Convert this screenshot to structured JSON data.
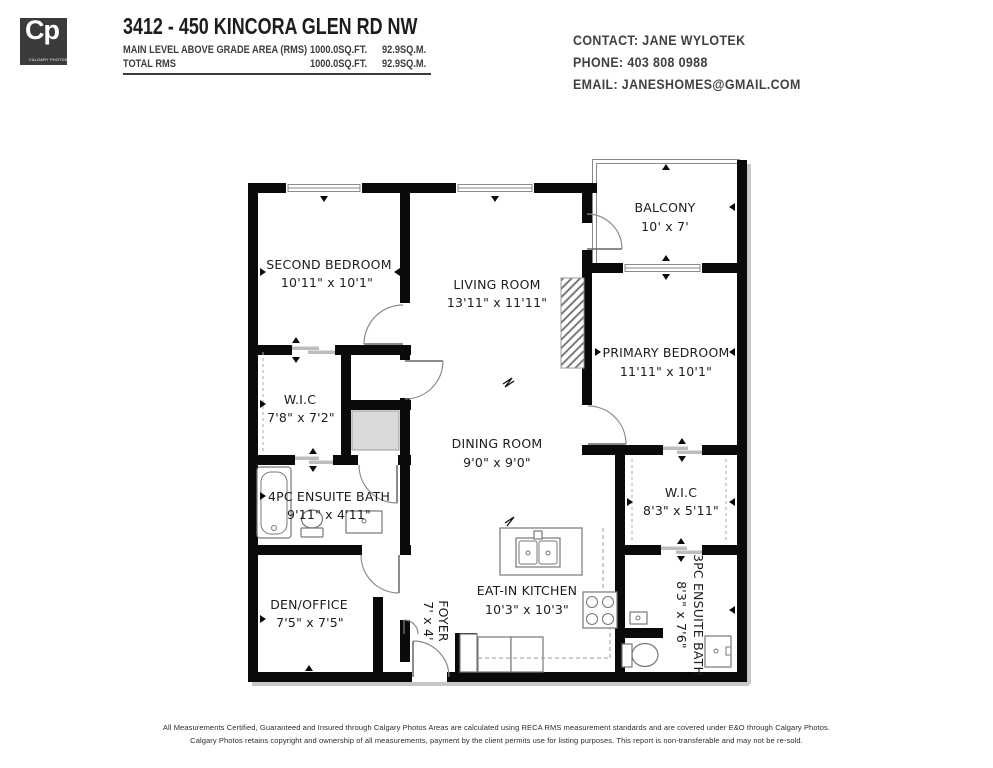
{
  "header": {
    "logo": {
      "initials": "Cp",
      "subtitle": "CALGARY PHOTOS"
    },
    "title": "3412 - 450 KINCORA GLEN RD NW",
    "area_rows": [
      {
        "label": "MAIN LEVEL ABOVE GRADE AREA (RMS)",
        "sqft": "1000.0SQ.FT.",
        "sqm": "92.9SQ.M."
      },
      {
        "label": "TOTAL RMS",
        "sqft": "1000.0SQ.FT.",
        "sqm": "92.9SQ.M."
      }
    ],
    "contact": {
      "contact_line": "CONTACT: JANE WYLOTEK",
      "phone_line": "PHONE: 403 808 0988",
      "email_line": "EMAIL: JANESHOMES@GMAIL.COM"
    }
  },
  "plan": {
    "rooms": [
      {
        "name": "SECOND BEDROOM",
        "dims": "10'11\" x 10'1\""
      },
      {
        "name": "LIVING ROOM",
        "dims": "13'11\" x 11'11\""
      },
      {
        "name": "BALCONY",
        "dims": "10' x 7'"
      },
      {
        "name": "PRIMARY BEDROOM",
        "dims": "11'11\" x 10'1\""
      },
      {
        "name": "W.I.C",
        "dims": "7'8\" x 7'2\""
      },
      {
        "name": "DINING ROOM",
        "dims": "9'0\" x 9'0\""
      },
      {
        "name": "4PC ENSUITE BATH",
        "dims": "9'11\" x 4'11\""
      },
      {
        "name": "W.I.C",
        "dims": "8'3\" x 5'11\""
      },
      {
        "name": "DEN/OFFICE",
        "dims": "7'5\" x 7'5\""
      },
      {
        "name": "FOYER",
        "dims": "7' x 4'"
      },
      {
        "name": "EAT-IN KITCHEN",
        "dims": "10'3\" x 10'3\""
      },
      {
        "name": "3PC ENSUITE BATH",
        "dims": "8'3\" x 7'6\""
      }
    ]
  },
  "footer": {
    "line1": "All Measurements Certified, Guaranteed and Insured through Calgary Photos Areas are calculated using RECA RMS measurement standards and are covered under E&O through Calgary Photos.",
    "line2": "Calgary Photos retains copyright and ownership of all measurements, payment by the client permits use for listing purposes. This report is non-transferable and may not be re-sold."
  },
  "colors": {
    "wall": "#0a0a0a",
    "header_ink": "#3d3d3d",
    "logo_bg": "#3b3b3b",
    "plan_ink": "#1c1c1c"
  }
}
